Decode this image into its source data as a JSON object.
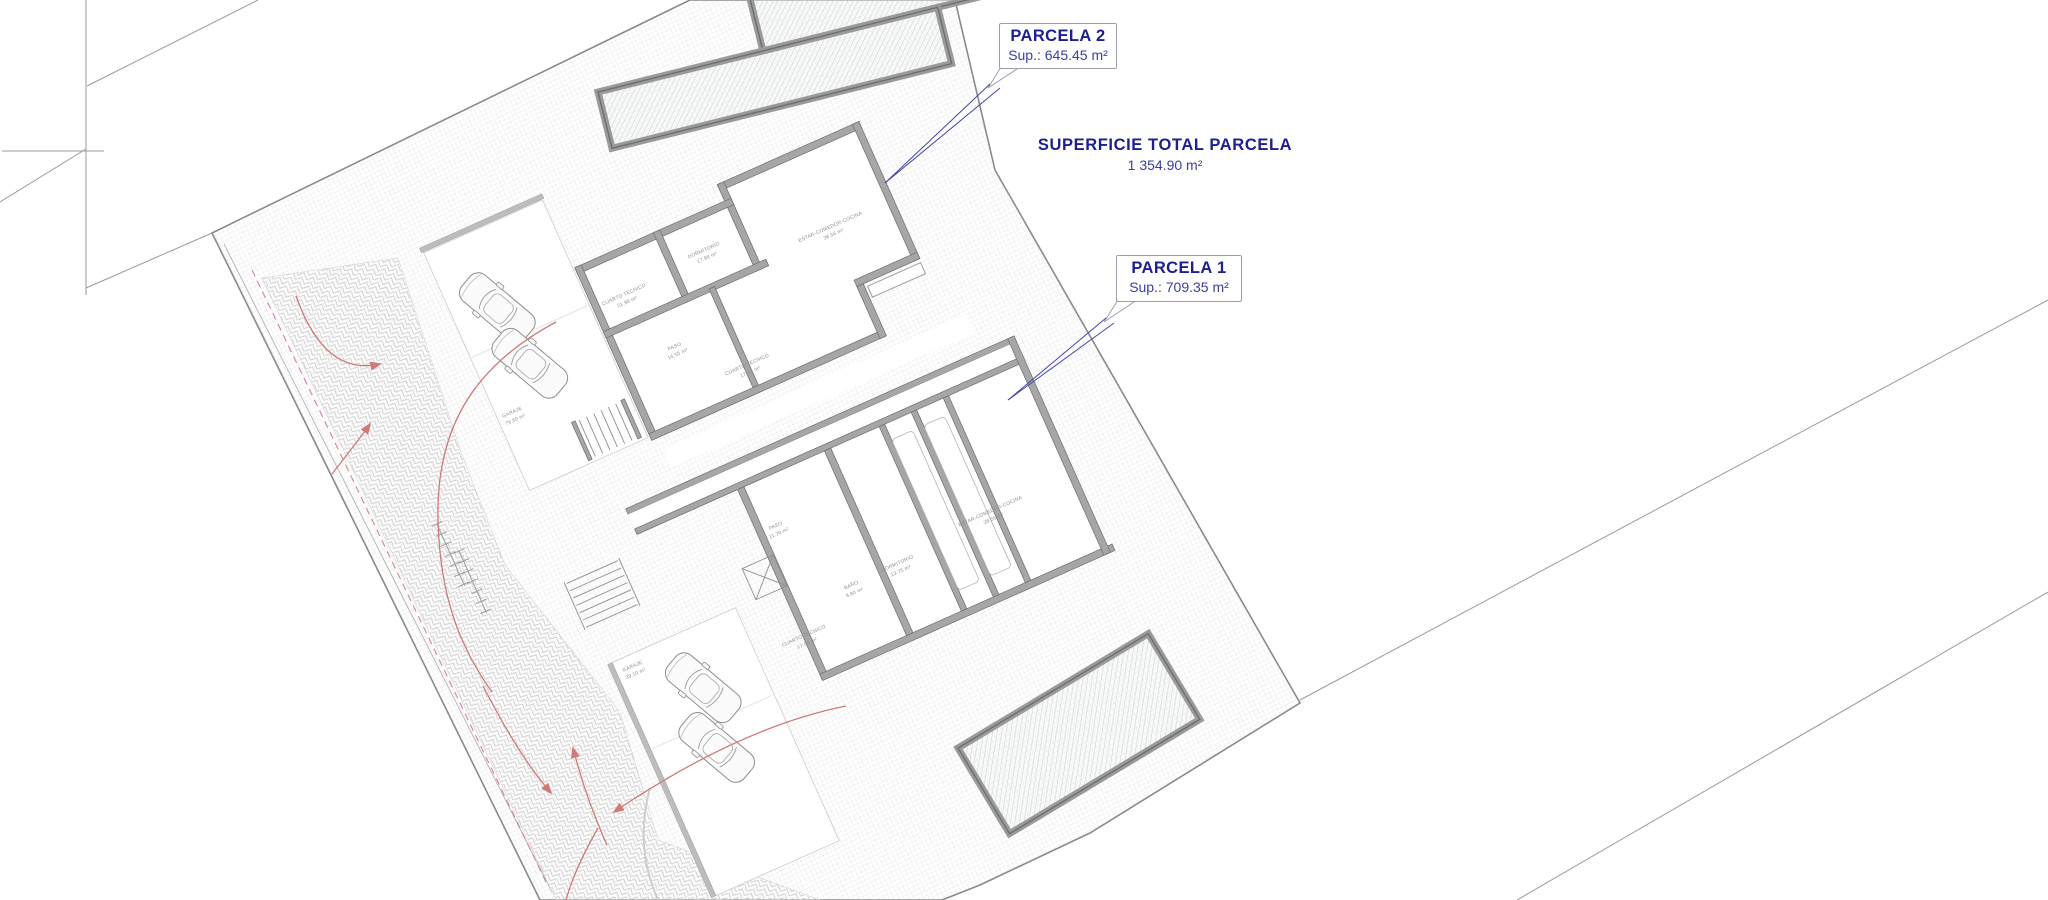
{
  "callouts": {
    "parcela2": {
      "title": "PARCELA 2",
      "sup": "Sup.: 645.45 m²"
    },
    "parcela1": {
      "title": "PARCELA 1",
      "sup": "Sup.: 709.35 m²"
    },
    "total": {
      "title": "SUPERFICIE TOTAL PARCELA",
      "value": "1 354.90 m²"
    }
  },
  "rooms": {
    "upper": [
      {
        "name": "ESTAR-COMEDOR-COCINA",
        "area": "38.56 m²"
      },
      {
        "name": "DORMITORIO",
        "area": "17.88 m²"
      },
      {
        "name": "CUARTO TECNICO",
        "area": "21.98 m²"
      },
      {
        "name": "PASO",
        "area": "16.55 m²"
      },
      {
        "name": "CUARTO TECNICO",
        "area": "17.48 m²"
      },
      {
        "name": "GARAJE",
        "area": "76.60 m²"
      }
    ],
    "lower": [
      {
        "name": "ESTAR-COMEDOR-COCINA",
        "area": "38.56 m²"
      },
      {
        "name": "DORMITORIO",
        "area": "13.75 m²"
      },
      {
        "name": "BAÑO",
        "area": "9.90 m²"
      },
      {
        "name": "PASO",
        "area": "11.70 m²"
      },
      {
        "name": "CUARTO TECNICO",
        "area": "17.88 m²"
      },
      {
        "name": "GARAJE",
        "area": "39.10 m²"
      }
    ]
  },
  "colors": {
    "navy": "#1c218f",
    "navy_sub": "#3a3f9e",
    "leader_blue": "#4247a6",
    "red_arrow": "#cf7a76",
    "wall_gray": "#a6a6a6",
    "boundary_gray": "#9a9a9a"
  }
}
